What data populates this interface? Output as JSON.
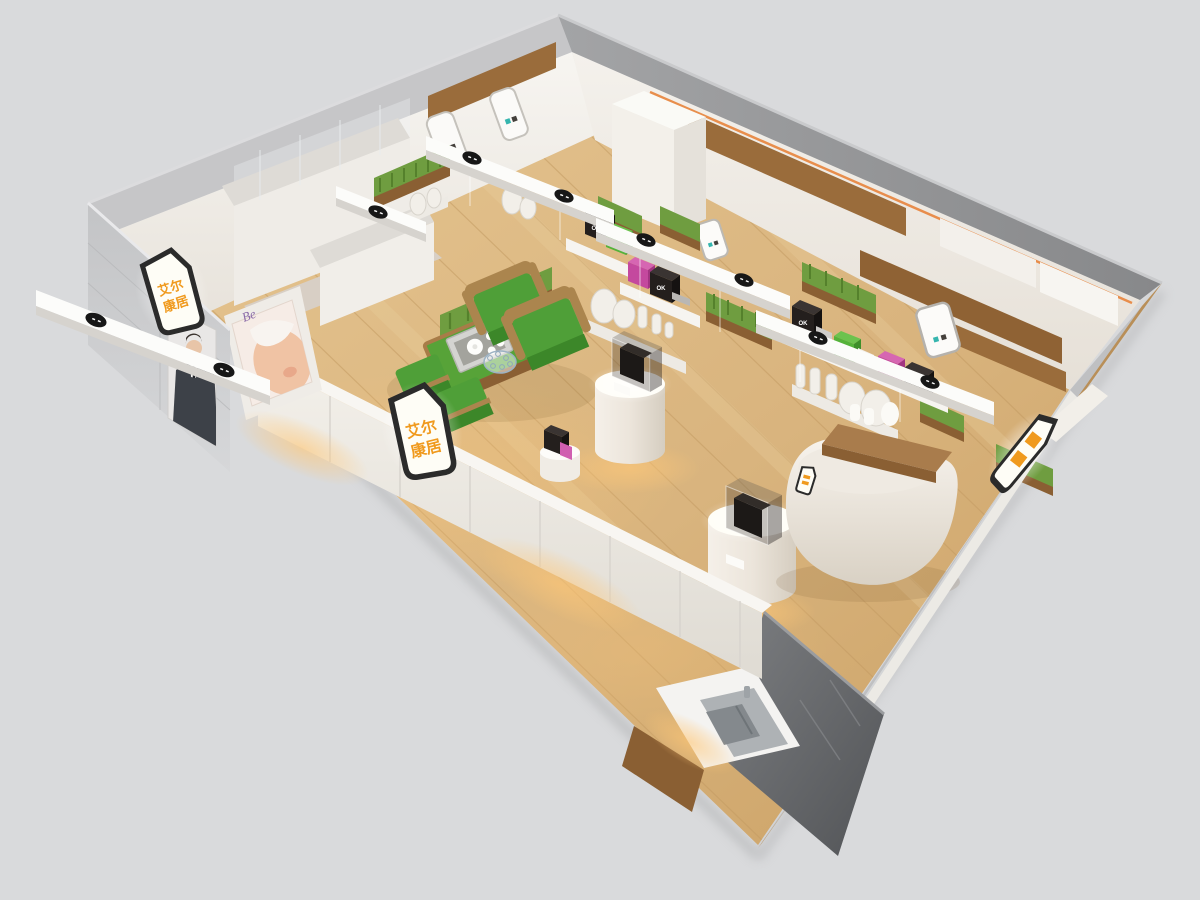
{
  "scene": {
    "type": "3d-isometric-render",
    "subject": "Cutaway bird's-eye render of a retail showroom booth: wood floor, white display walls, green lounge furniture, display pedestals, reception desk and lightbox brand signs"
  },
  "brand_sign": {
    "line1": "艾尔",
    "line2": "康居",
    "full_text": "艾尔康居",
    "text_color": "#f09a1e",
    "face_color": "#fefdf6",
    "border_color": "#2b2b2b",
    "signs_visible": 3
  },
  "posters": {
    "beauty_poster_text": "Be",
    "suit_poster_subject": "man in dark suit"
  },
  "product_cubes": {
    "label": "OK",
    "colors": [
      "#241f1d",
      "#55b23a",
      "#c4499e"
    ]
  },
  "materials": {
    "background": "#d9dadc",
    "floor_wood": "#d9b47e",
    "floor_wood_shadow": "#c49a63",
    "outer_wall_gray": "#c0c1c3",
    "corner_pillar_gray": "#67696c",
    "inner_wall_white": "#f2efe9",
    "wall_wood_panel": "#9a6c3b",
    "grass_green": "#6f9d40",
    "lounge_green": "#4f9f38",
    "frame_wood": "#ab854e",
    "accent_orange_line": "#e8843c",
    "warm_light": "#ffbe6e"
  },
  "inventory": {
    "armchairs": 2,
    "stools": 2,
    "coffee_tables": 1,
    "display_pedestals": 2,
    "reception_desks": 1,
    "sink_displays": 1,
    "ceiling_light_beams": 5,
    "grass_planters": 8
  }
}
